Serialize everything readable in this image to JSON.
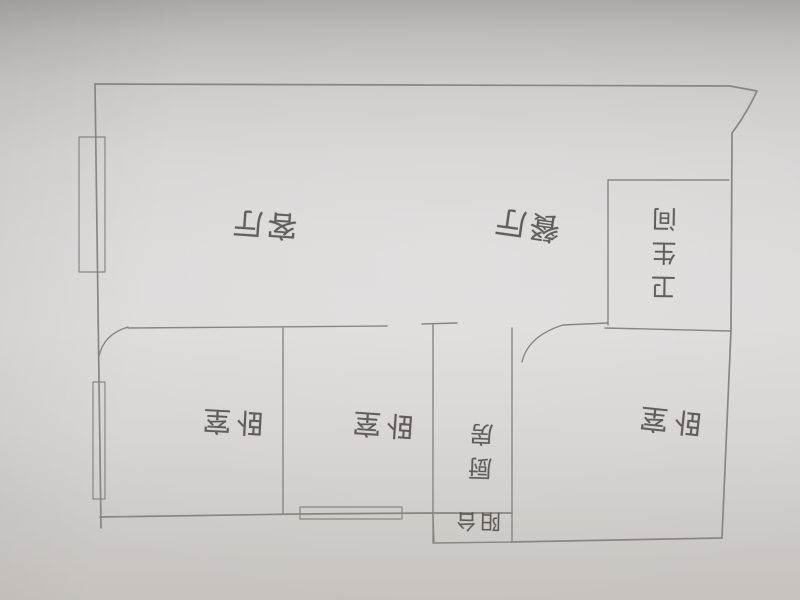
{
  "colors": {
    "paper": "#d8d5d4",
    "pencil": "#8a8581",
    "handwriting": "#524c48"
  },
  "floor_plan": {
    "rooms": [
      {
        "id": "living-room",
        "label": "客厅"
      },
      {
        "id": "dining-room",
        "label": "餐厅"
      },
      {
        "id": "bathroom",
        "label": "卫生间"
      },
      {
        "id": "bedroom-left",
        "label": "卧室"
      },
      {
        "id": "bedroom-middle",
        "label": "卧室"
      },
      {
        "id": "kitchen",
        "label": "厨房"
      },
      {
        "id": "balcony",
        "label": "阳台"
      },
      {
        "id": "bedroom-right",
        "label": "卧室"
      }
    ]
  }
}
